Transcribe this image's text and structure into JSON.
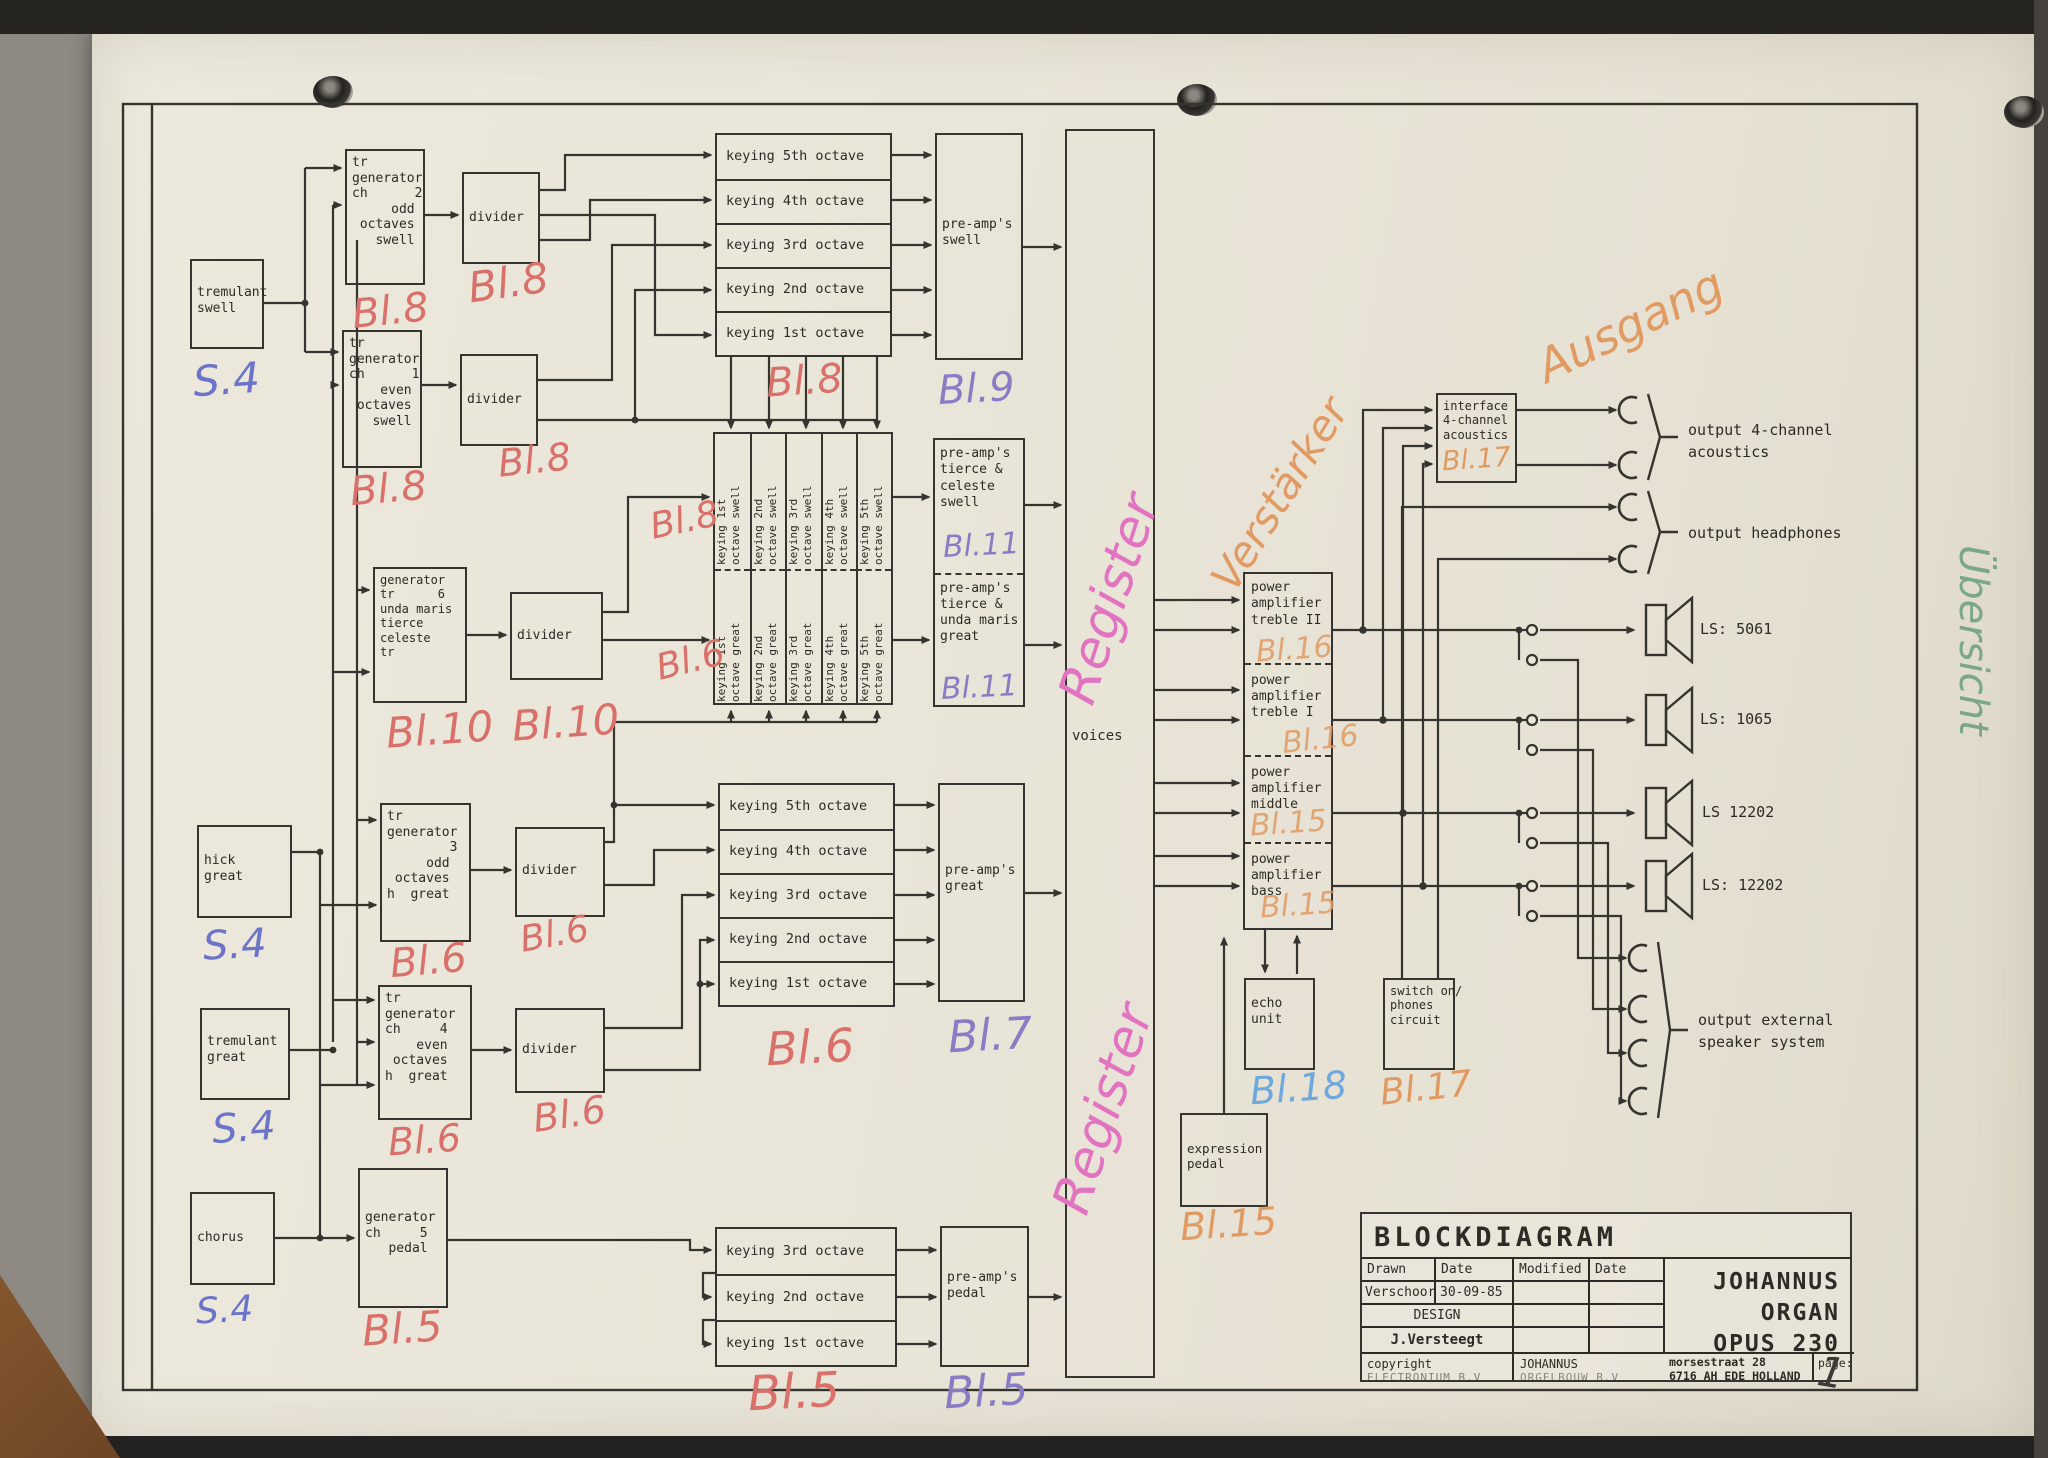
{
  "document": {
    "type": "scanned organ blockdiagram",
    "title": "BLOCKDIAGRAM",
    "product_line1": "JOHANNUS",
    "product_line2": "ORGAN",
    "product_line3": "OPUS  230"
  },
  "colors": {
    "ink": "#35342f",
    "paper": "#eae6da",
    "annotation_red": "#d9706a",
    "annotation_blue": "#6b74c9",
    "annotation_purple": "#8a7cc4",
    "annotation_orange": "#e09a62",
    "annotation_pink": "#e273c0",
    "annotation_lightblue": "#6fa8dc",
    "annotation_green": "#7aa884"
  },
  "blocks": {
    "tremulant_swell": {
      "label": "tremulant\nswell"
    },
    "generator2": {
      "label": "tr\ngenerator\nch      2\n     odd\n octaves\n   swell"
    },
    "generator1": {
      "label": "tr\ngenerator\nch      1\n    even\n octaves\n   swell"
    },
    "generator6": {
      "label": "generator\ntr      6\nunda maris\ntierce\nceleste\ntr"
    },
    "generator3": {
      "label": "tr\ngenerator\n        3\n     odd\n octaves\nh  great"
    },
    "generator4": {
      "label": "tr\ngenerator\nch     4\n    even\n octaves\nh  great"
    },
    "generator5": {
      "label": "generator\nch     5\n   pedal"
    },
    "divider": {
      "label": "divider"
    },
    "hick_great": {
      "label": "hick\ngreat"
    },
    "tremulant_great": {
      "label": "tremulant\ngreat"
    },
    "chorus": {
      "label": "chorus"
    },
    "preamp_swell": {
      "label": "pre-amp's\nswell"
    },
    "preamp_tierce_celeste": {
      "label": "pre-amp's\ntierce &\nceleste\nswell"
    },
    "preamp_tierce_unda": {
      "label": "pre-amp's\ntierce &\nunda maris\ngreat"
    },
    "preamp_great": {
      "label": "pre-amp's\ngreat"
    },
    "preamp_pedal": {
      "label": "pre-amp's\npedal"
    },
    "power_treble2": {
      "label": "power\namplifier\ntreble II"
    },
    "power_treble1": {
      "label": "power\namplifier\ntreble I"
    },
    "power_middle": {
      "label": "power\namplifier\nmiddle"
    },
    "power_bass": {
      "label": "power\namplifier\nbass"
    },
    "echo_unit": {
      "label": "echo\nunit"
    },
    "switch_phones": {
      "label": "switch on/\nphones\ncircuit"
    },
    "expression_pedal": {
      "label": "expression\npedal"
    },
    "interface": {
      "label": "interface\n4-channel\nacoustics"
    },
    "voices": {
      "label": "voices"
    }
  },
  "keying_rows": [
    "keying 5th octave",
    "keying 4th octave",
    "keying 3rd octave",
    "keying 2nd octave",
    "keying 1st octave"
  ],
  "keying_pedal_rows": [
    "keying 3rd octave",
    "keying 2nd octave",
    "keying 1st octave"
  ],
  "matrix_swell": [
    "keying 1st\noctave swell",
    "keying 2nd\noctave swell",
    "keying 3rd\noctave swell",
    "keying 4th\noctave swell",
    "keying 5th\noctave swell"
  ],
  "matrix_great": [
    "keying 1st\noctave great",
    "keying 2nd\noctave great",
    "keying 3rd\noctave great",
    "keying 4th\noctave great",
    "keying 5th\noctave great"
  ],
  "outputs": {
    "four_channel": "output 4-channel\nacoustics",
    "headphones": "output headphones",
    "external": "output external\nspeaker system"
  },
  "speakers": [
    "LS: 5061",
    "LS: 1065",
    "LS 12202",
    "LS: 12202"
  ],
  "annotations": {
    "s4": "S.4",
    "bl5": "Bl.5",
    "bl6": "Bl.6",
    "bl7": "Bl.7",
    "bl8": "Bl.8",
    "bl9": "Bl.9",
    "bl10": "Bl.10",
    "bl11": "Bl.11",
    "bl15": "Bl.15",
    "bl16": "Bl.16",
    "bl17": "Bl.17",
    "bl18": "Bl.18",
    "register": "Register",
    "verstaerker": "Verstärker",
    "ausgang": "Ausgang",
    "uebersicht": "Übersicht",
    "page_number": "1"
  },
  "title_block": {
    "title": "BLOCKDIAGRAM",
    "drawn_label": "Drawn",
    "date_label": "Date",
    "modified_label": "Modified",
    "date2_label": "Date",
    "drawn_by": "Verschoor",
    "drawn_date": "30-09-85",
    "design_label": "DESIGN",
    "designer": "J.Versteegt",
    "org_line1": "JOHANNUS",
    "org_line2": "ORGAN",
    "org_line3": "OPUS  230",
    "copyright_label": "copyright",
    "copyright_company": "ELECTRONIUM B.V",
    "maker": "JOHANNUS",
    "maker2": "ORGELBOUW B.V",
    "address_line1": "morsestraat 28",
    "address_line2": "6716 AH EDE HOLLAND",
    "page_label": "page:"
  }
}
